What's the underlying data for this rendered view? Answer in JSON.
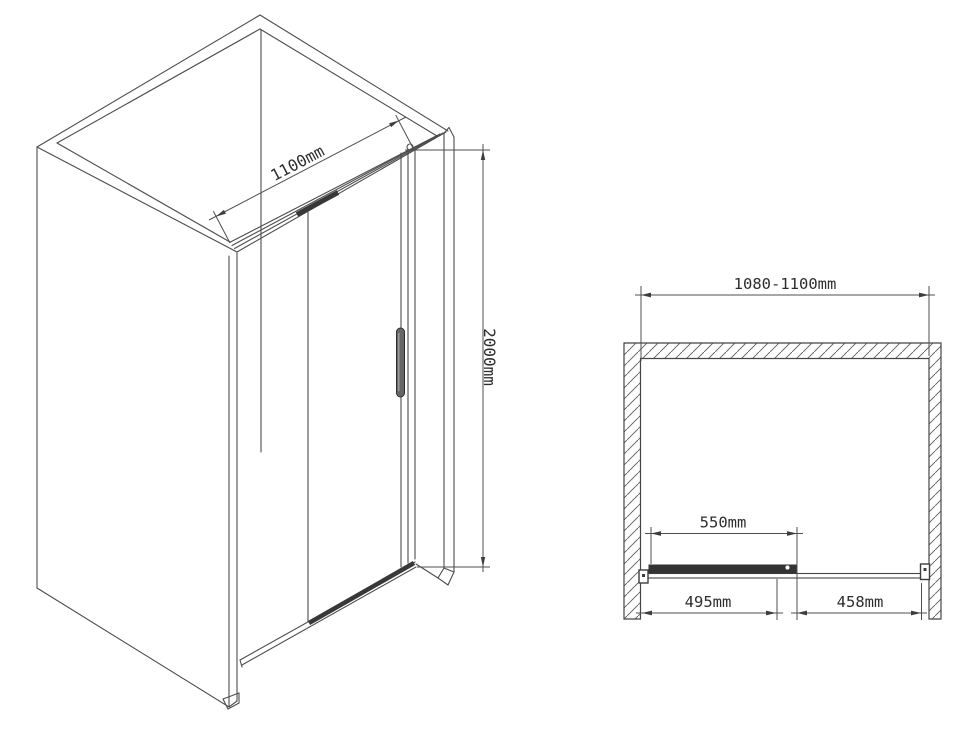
{
  "drawing": {
    "background_color": "#ffffff",
    "line_color": "#4d4d4d",
    "dark_fill_color": "#383838",
    "text_color": "#2d2d2d"
  },
  "isometric_view": {
    "width_dimension": "1100mm",
    "height_dimension": "2000mm"
  },
  "plan_view": {
    "total_width_dimension": "1080-1100mm",
    "door_width_dimension": "550mm",
    "left_section_dimension": "495mm",
    "right_section_dimension": "458mm"
  }
}
